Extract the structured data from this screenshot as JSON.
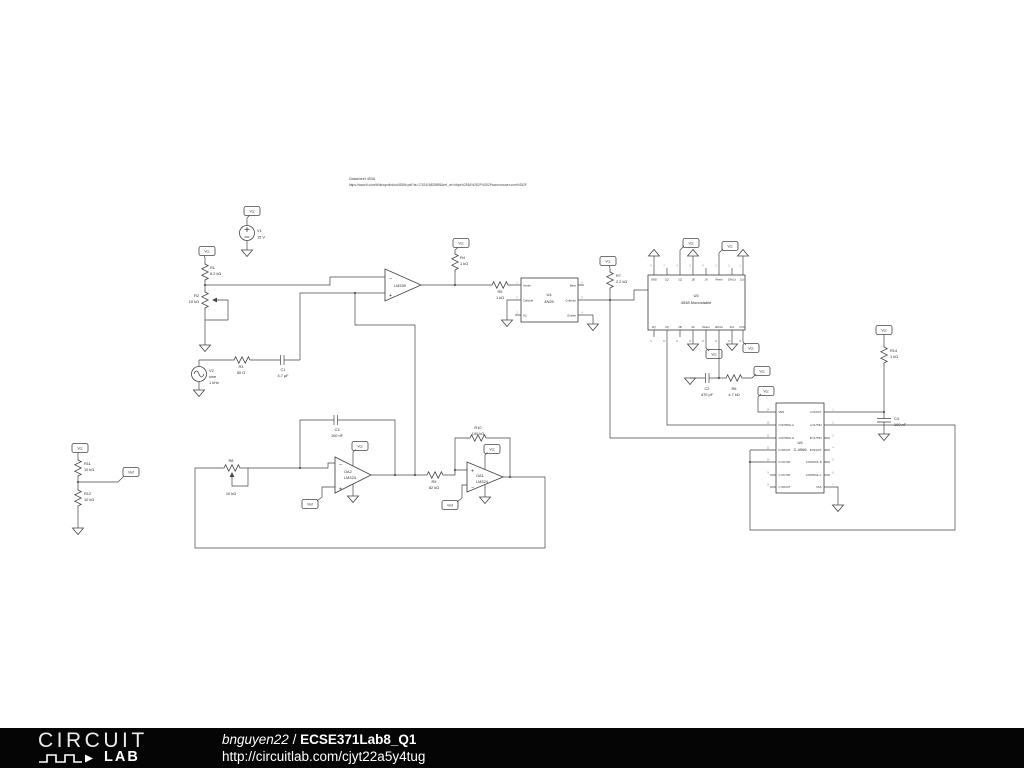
{
  "canvas": {
    "note_line1": "Datasheet 4538",
    "note_line2": "https://www.ti.com/lit/ds/symlink/cd4538b.pdf?ts=1742416825895&ref_url=https%253A%252F%252Fwww.mouser.com%252F"
  },
  "flags": {
    "vcc": "Vcc",
    "vref": "Vref"
  },
  "components": {
    "v1": {
      "ref": "V1",
      "value": "15 V"
    },
    "v2": {
      "ref": "V2",
      "type": "sine",
      "value": "1 kHz"
    },
    "r1": {
      "ref": "R1",
      "value": "8.2 kΩ"
    },
    "r2": {
      "ref": "R2",
      "value": "10 kΩ"
    },
    "r3": {
      "ref": "R3",
      "value": "50 Ω"
    },
    "r4": {
      "ref": "R4",
      "value": "1 kΩ"
    },
    "r5": {
      "ref": "R5",
      "value": "1 kΩ"
    },
    "r6": {
      "ref": "R6",
      "value": "4.7 kΩ"
    },
    "r7": {
      "ref": "R7",
      "value": "2.2 kΩ"
    },
    "r8": {
      "ref": "R8",
      "value": "10 kΩ"
    },
    "r9": {
      "ref": "R9",
      "value": "82 kΩ"
    },
    "r10": {
      "ref": "R10",
      "value": "100 kΩ"
    },
    "r11": {
      "ref": "R11",
      "value": "10 kΩ"
    },
    "r12": {
      "ref": "R12",
      "value": "10 kΩ"
    },
    "r14": {
      "ref": "R14",
      "value": "1 kΩ"
    },
    "c1": {
      "ref": "C1",
      "value": "4.7 µF"
    },
    "c2": {
      "ref": "C2",
      "value": "470 pF"
    },
    "c3": {
      "ref": "C3",
      "value": "100 nF"
    },
    "c4": {
      "ref": "C4",
      "value": "100 nF"
    },
    "cmp1": {
      "label": "LM339",
      "minus": "−",
      "plus": "+"
    },
    "oa2": {
      "ref": "OA2",
      "label": "LM324",
      "minus": "−",
      "plus": "+"
    },
    "oa1": {
      "ref": "OA1",
      "label": "LM324",
      "minus": "−",
      "plus": "+"
    },
    "u4": {
      "ref": "U4",
      "part": "4N25",
      "pins_left": [
        "Anode",
        "Cathode",
        "NC"
      ],
      "pins_left_nums": [
        "1",
        "2",
        "3"
      ],
      "pins_right": [
        "Base",
        "Collector",
        "Emitter"
      ],
      "pins_right_nums": [
        "6",
        "5",
        "4"
      ]
    },
    "u5": {
      "ref": "U5",
      "part": "4538 Monostable",
      "pins_top": [
        "GND",
        "1Q'",
        "1Q",
        "1B",
        "1A",
        "Reset",
        "1RxCx",
        "1Cx"
      ],
      "pins_top_nums": [
        "8",
        "7",
        "6",
        "5",
        "4",
        "3",
        "2",
        "1"
      ],
      "pins_bottom": [
        "2Q'",
        "2Q",
        "2B",
        "2A",
        "Reset",
        "2RxCx",
        "2Cx",
        "VCC"
      ],
      "pins_bottom_nums": [
        "9",
        "10",
        "11",
        "12",
        "13",
        "14",
        "15",
        "16"
      ]
    },
    "u6": {
      "ref": "U6",
      "part": "C-4066",
      "pins_left": [
        "VDD",
        "CONTROL A",
        "CONTROL D",
        "D IN/OUT",
        "D OUT/IN",
        "C OUT/IN",
        "C IN/OUT"
      ],
      "pins_left_nums": [
        "14",
        "13",
        "12",
        "11",
        "10",
        "9",
        "8"
      ],
      "pins_right": [
        "A IN/OUT",
        "A OUT/IN",
        "B OUT/IN",
        "B IN/OUT",
        "CONTROL B",
        "CONTROL C",
        "VSS"
      ],
      "pins_right_nums": [
        "1",
        "2",
        "3",
        "4",
        "5",
        "6",
        "7"
      ]
    }
  },
  "footer": {
    "logo_line1": "CIRCUIT",
    "logo_line2": "LAB",
    "username": "bnguyen22",
    "separator": " / ",
    "title": "ECSE371Lab8_Q1",
    "url": "http://circuitlab.com/cjyt22a5y4tug"
  }
}
